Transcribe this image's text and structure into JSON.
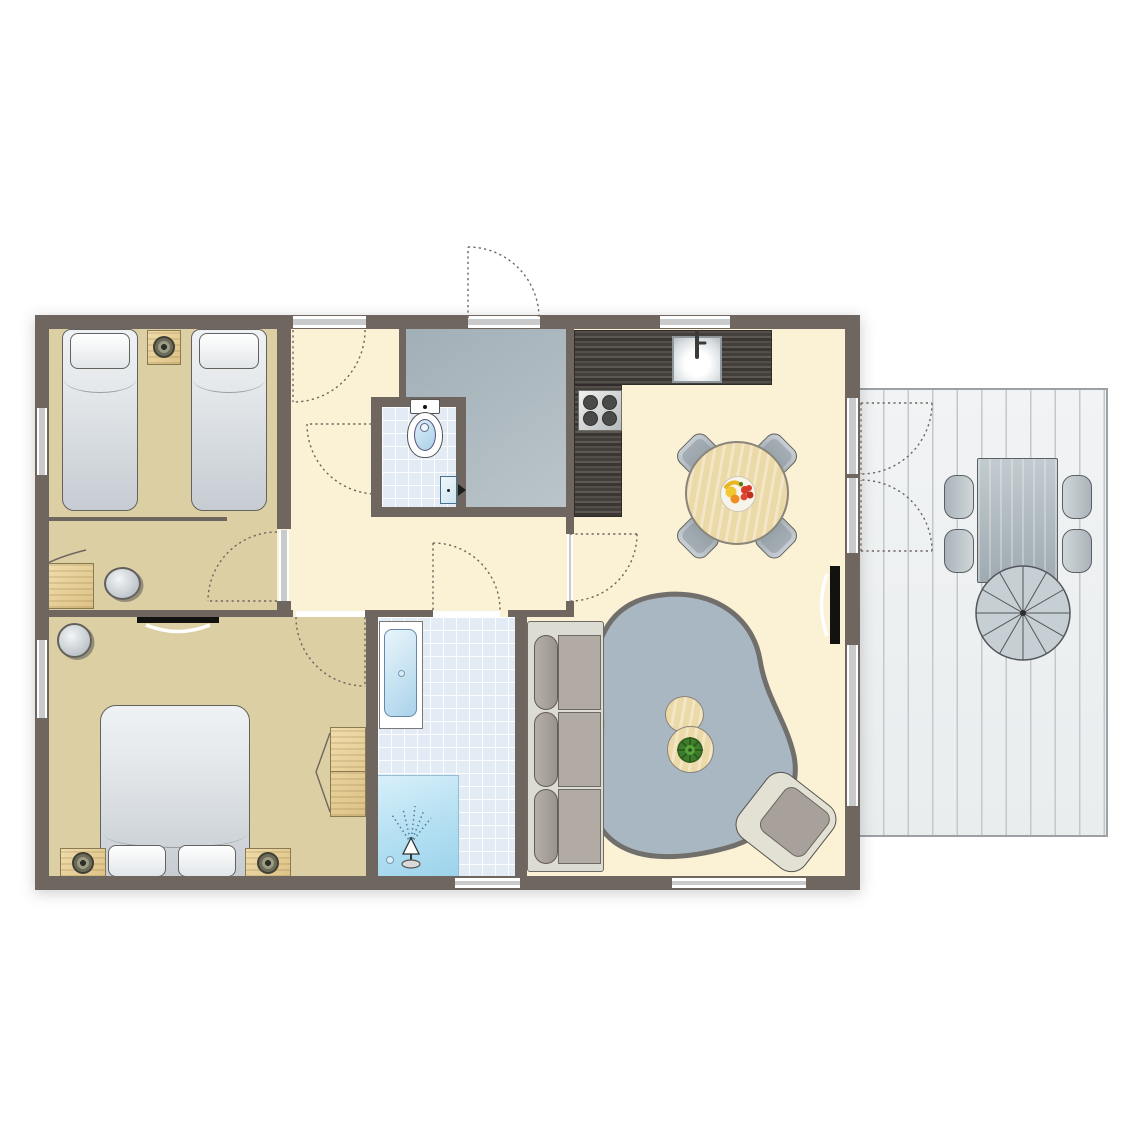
{
  "type": "floor-plan",
  "colors": {
    "wall": "#6f6660",
    "floor_main": "#fbf1d4",
    "floor_bedroom": "#dccfa4",
    "entry_floor": "#a9b6bd",
    "tile": "#e3ebf5",
    "shower": "#b9e2f3",
    "counter": "#46423e",
    "deck": "#eef0f1",
    "deck_line": "#c3c8cb",
    "furniture_gray": "#b9c0c6",
    "wood_light": "#ecd9a8",
    "rug": "#a9b7c3",
    "sofa": "#aaa49d",
    "bed_linen": "#dfe5e9",
    "tv": "#121210",
    "plant": "#3e7d2b",
    "opening": "#c9cacb",
    "fruit_red": "#d93b2b",
    "fruit_yellow": "#f2c832",
    "fruit_orange": "#ef8f1f"
  },
  "rooms": [
    {
      "name": "twin-bedroom",
      "furniture": [
        "single-bed",
        "single-bed",
        "nightstand-with-lamp"
      ]
    },
    {
      "name": "study-nook",
      "furniture": [
        "desk",
        "stool"
      ]
    },
    {
      "name": "hallway",
      "furniture": []
    },
    {
      "name": "entry",
      "furniture": []
    },
    {
      "name": "wc",
      "furniture": [
        "toilet",
        "door"
      ]
    },
    {
      "name": "kitchen",
      "furniture": [
        "l-shaped-counter",
        "sink-with-faucet",
        "cooktop-4-burners"
      ]
    },
    {
      "name": "dining-area",
      "furniture": [
        "round-dining-table",
        "dining-chair",
        "dining-chair",
        "dining-chair",
        "dining-chair",
        "fruit-bowl"
      ]
    },
    {
      "name": "master-bedroom",
      "furniture": [
        "double-bed",
        "nightstand-with-lamp",
        "nightstand-with-lamp",
        "wardrobe",
        "wall-tv",
        "pouf"
      ]
    },
    {
      "name": "bathroom",
      "furniture": [
        "washbasin-counter",
        "walk-in-shower"
      ]
    },
    {
      "name": "living-room",
      "furniture": [
        "three-seat-sofa",
        "area-rug",
        "coffee-table",
        "coffee-table",
        "potted-plant",
        "armchair",
        "wall-tv"
      ]
    },
    {
      "name": "terrace",
      "furniture": [
        "outdoor-dining-table",
        "outdoor-chair",
        "outdoor-chair",
        "outdoor-chair",
        "outdoor-chair",
        "parasol"
      ]
    }
  ],
  "openings": {
    "windows": 7,
    "entrance_doors": 2,
    "interior_doors": 5,
    "french_doors_to_terrace": 2
  }
}
